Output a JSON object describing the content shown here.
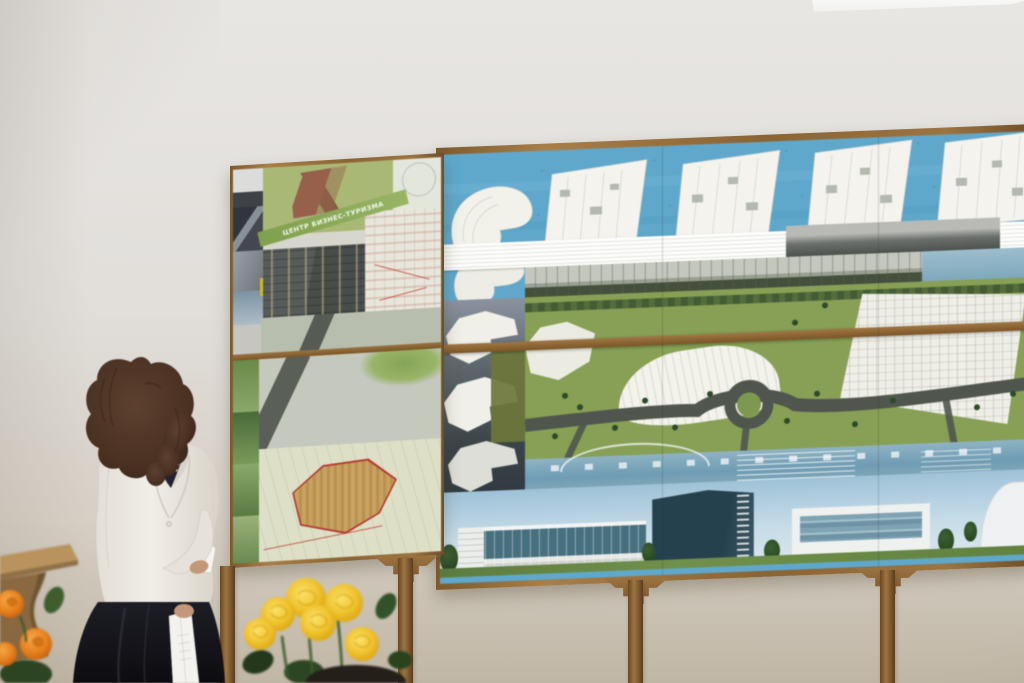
{
  "scene": {
    "description": "Presenter beside architectural masterplan exhibition boards",
    "left_board": {
      "banner_text": "ЦЕНТР БИЗНЕС-ТУРИЗМА"
    },
    "palette": {
      "wall": "#e2ded9",
      "wood_frame": "#96703c",
      "water_blue": "#5fa8cb",
      "plan_white": "#f2f1ea",
      "masterplan_green": "#87a055",
      "road_gray": "#50564e",
      "render_sky": "#a8c8dc",
      "glass_teal": "#47707f",
      "rose_yellow": "#f0c430",
      "flower_orange": "#e8821e",
      "dress_black": "#17171d",
      "cardigan_white": "#ece8e1",
      "hair_brown": "#503524",
      "table_wood": "#b8935e"
    }
  }
}
